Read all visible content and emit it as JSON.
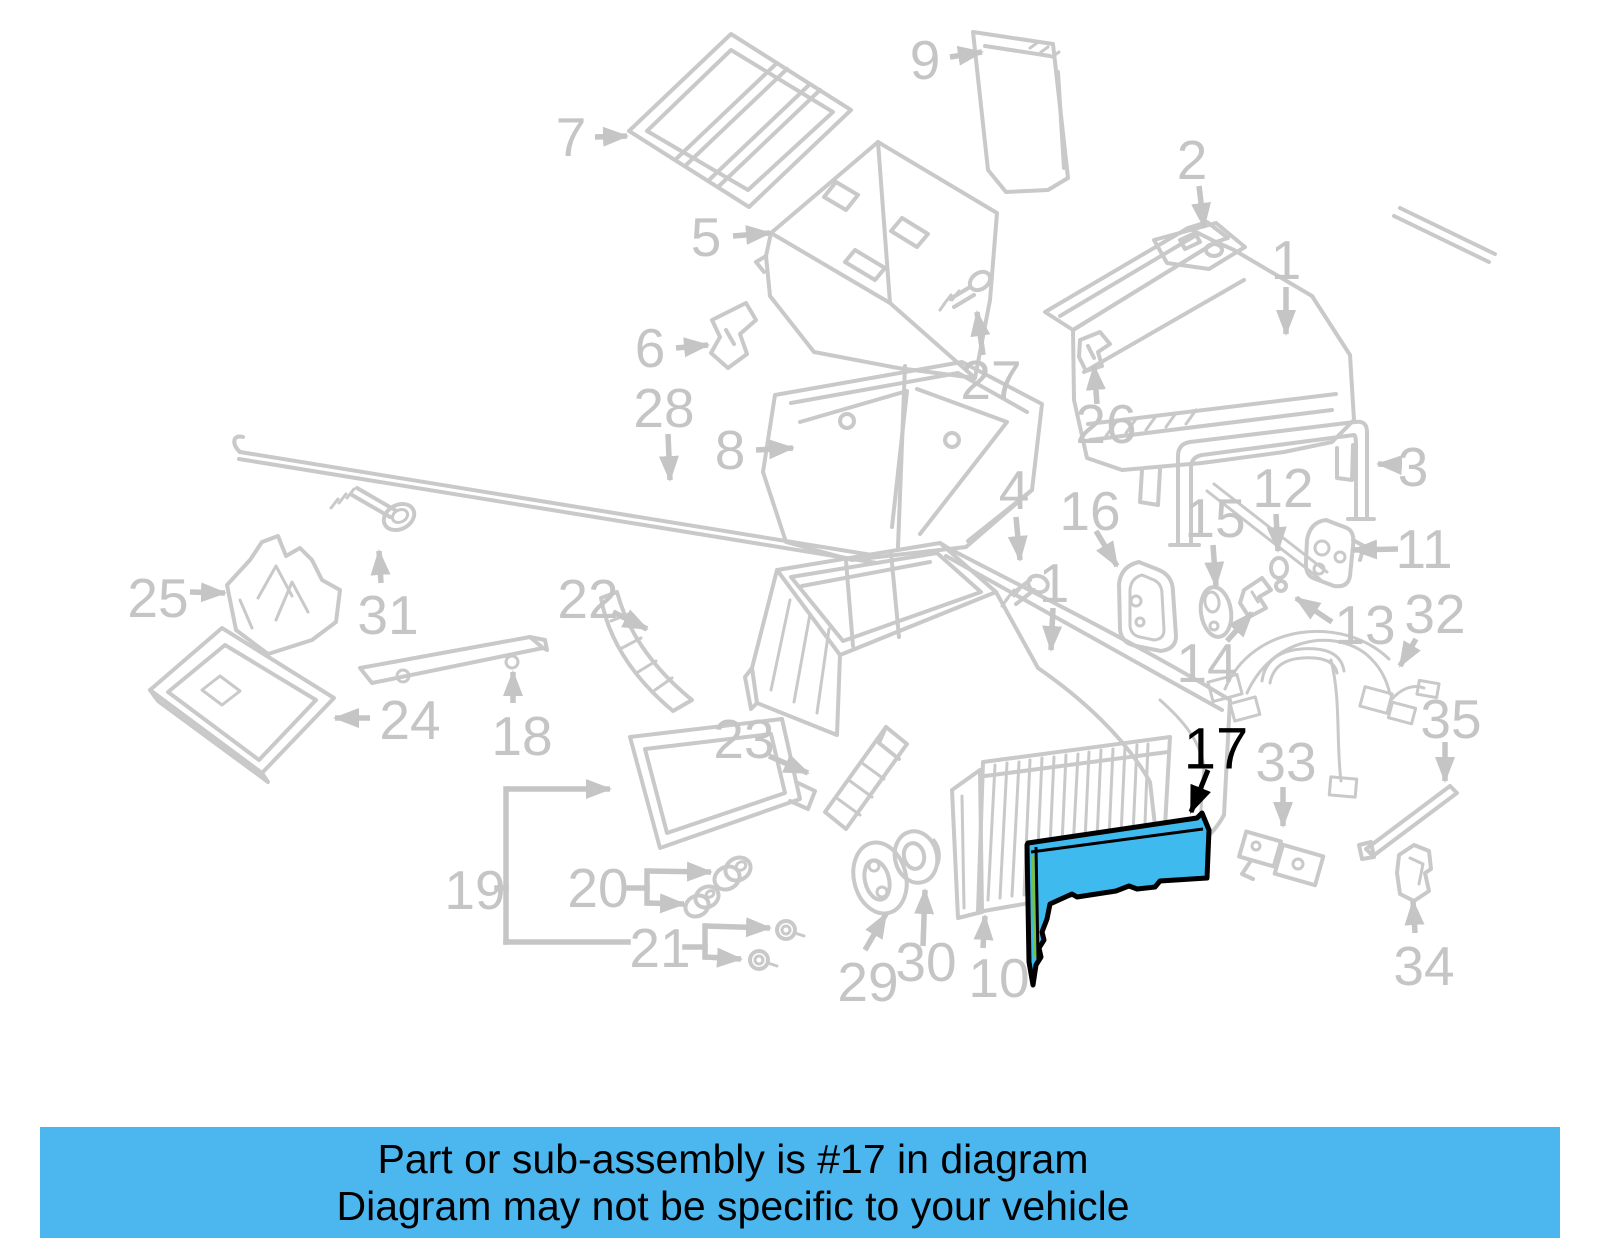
{
  "banner": {
    "line1": "Part or sub-assembly is #17 in diagram",
    "line2": "Diagram may not be specific to your vehicle",
    "background_color": "#4cb6ef",
    "text_color": "#000000"
  },
  "diagram": {
    "background_color": "#ffffff",
    "line_color": "#c9c9c9",
    "label_color": "#c5c5c5",
    "highlight_color": "#000000",
    "highlighted_part": {
      "number": "17",
      "fill_color": "#3fbaee",
      "outline_color": "#000000",
      "accent_color": "#76c043"
    },
    "labels": [
      {
        "n": "7",
        "x": 571,
        "y": 137
      },
      {
        "n": "5",
        "x": 706,
        "y": 237
      },
      {
        "n": "6",
        "x": 650,
        "y": 348
      },
      {
        "n": "9",
        "x": 925,
        "y": 60
      },
      {
        "n": "2",
        "x": 1192,
        "y": 160
      },
      {
        "n": "1",
        "x": 1286,
        "y": 260
      },
      {
        "n": "27",
        "x": 991,
        "y": 380
      },
      {
        "n": "28",
        "x": 664,
        "y": 408
      },
      {
        "n": "8",
        "x": 730,
        "y": 450
      },
      {
        "n": "26",
        "x": 1106,
        "y": 424
      },
      {
        "n": "3",
        "x": 1413,
        "y": 467
      },
      {
        "n": "4",
        "x": 1014,
        "y": 490
      },
      {
        "n": "16",
        "x": 1090,
        "y": 511
      },
      {
        "n": "15",
        "x": 1215,
        "y": 518
      },
      {
        "n": "12",
        "x": 1283,
        "y": 488
      },
      {
        "n": "11",
        "x": 1424,
        "y": 549
      },
      {
        "n": "1",
        "x": 1054,
        "y": 583
      },
      {
        "n": "13",
        "x": 1365,
        "y": 625
      },
      {
        "n": "32",
        "x": 1435,
        "y": 614
      },
      {
        "n": "14",
        "x": 1207,
        "y": 663
      },
      {
        "n": "25",
        "x": 158,
        "y": 598
      },
      {
        "n": "31",
        "x": 388,
        "y": 615
      },
      {
        "n": "22",
        "x": 588,
        "y": 599
      },
      {
        "n": "24",
        "x": 410,
        "y": 720
      },
      {
        "n": "18",
        "x": 522,
        "y": 736
      },
      {
        "n": "23",
        "x": 744,
        "y": 739
      },
      {
        "n": "17",
        "x": 1216,
        "y": 749,
        "hl": true
      },
      {
        "n": "33",
        "x": 1286,
        "y": 762
      },
      {
        "n": "35",
        "x": 1451,
        "y": 719
      },
      {
        "n": "19",
        "x": 475,
        "y": 890
      },
      {
        "n": "20",
        "x": 598,
        "y": 888
      },
      {
        "n": "21",
        "x": 660,
        "y": 948
      },
      {
        "n": "29",
        "x": 868,
        "y": 982
      },
      {
        "n": "30",
        "x": 926,
        "y": 962
      },
      {
        "n": "10",
        "x": 999,
        "y": 978
      },
      {
        "n": "34",
        "x": 1424,
        "y": 966
      }
    ],
    "arrows": [
      {
        "x1": 595,
        "y1": 137,
        "x2": 627,
        "y2": 136
      },
      {
        "x1": 733,
        "y1": 236,
        "x2": 770,
        "y2": 233
      },
      {
        "x1": 676,
        "y1": 348,
        "x2": 708,
        "y2": 345
      },
      {
        "x1": 950,
        "y1": 57,
        "x2": 982,
        "y2": 52
      },
      {
        "x1": 1199,
        "y1": 186,
        "x2": 1204,
        "y2": 227
      },
      {
        "x1": 1286,
        "y1": 287,
        "x2": 1286,
        "y2": 334
      },
      {
        "x1": 983,
        "y1": 355,
        "x2": 977,
        "y2": 312
      },
      {
        "x1": 668,
        "y1": 434,
        "x2": 670,
        "y2": 480
      },
      {
        "x1": 756,
        "y1": 450,
        "x2": 793,
        "y2": 448
      },
      {
        "x1": 1097,
        "y1": 404,
        "x2": 1094,
        "y2": 366
      },
      {
        "x1": 1400,
        "y1": 465,
        "x2": 1378,
        "y2": 464
      },
      {
        "x1": 1016,
        "y1": 517,
        "x2": 1020,
        "y2": 560
      },
      {
        "x1": 1096,
        "y1": 531,
        "x2": 1117,
        "y2": 566
      },
      {
        "x1": 1276,
        "y1": 514,
        "x2": 1278,
        "y2": 551
      },
      {
        "x1": 1213,
        "y1": 545,
        "x2": 1216,
        "y2": 586
      },
      {
        "x1": 1398,
        "y1": 549,
        "x2": 1353,
        "y2": 550
      },
      {
        "x1": 1053,
        "y1": 608,
        "x2": 1051,
        "y2": 650
      },
      {
        "x1": 1332,
        "y1": 622,
        "x2": 1296,
        "y2": 598
      },
      {
        "x1": 1416,
        "y1": 639,
        "x2": 1400,
        "y2": 666
      },
      {
        "x1": 1227,
        "y1": 641,
        "x2": 1252,
        "y2": 613
      },
      {
        "x1": 190,
        "y1": 592,
        "x2": 225,
        "y2": 593
      },
      {
        "x1": 381,
        "y1": 583,
        "x2": 379,
        "y2": 551
      },
      {
        "x1": 613,
        "y1": 612,
        "x2": 647,
        "y2": 629
      },
      {
        "x1": 370,
        "y1": 718,
        "x2": 335,
        "y2": 718
      },
      {
        "x1": 513,
        "y1": 703,
        "x2": 513,
        "y2": 672
      },
      {
        "x1": 769,
        "y1": 756,
        "x2": 808,
        "y2": 773
      },
      {
        "x1": 1208,
        "y1": 770,
        "x2": 1191,
        "y2": 812,
        "hl": true
      },
      {
        "x1": 1283,
        "y1": 787,
        "x2": 1283,
        "y2": 826
      },
      {
        "x1": 1445,
        "y1": 742,
        "x2": 1445,
        "y2": 781
      },
      {
        "x1": 865,
        "y1": 950,
        "x2": 886,
        "y2": 914
      },
      {
        "x1": 923,
        "y1": 946,
        "x2": 925,
        "y2": 890
      },
      {
        "x1": 983,
        "y1": 948,
        "x2": 985,
        "y2": 916
      },
      {
        "x1": 1415,
        "y1": 933,
        "x2": 1413,
        "y2": 901
      },
      {
        "x1": 506,
        "y1": 789,
        "x2": 610,
        "y2": 789
      },
      {
        "x1": 647,
        "y1": 871,
        "x2": 711,
        "y2": 872
      },
      {
        "x1": 647,
        "y1": 903,
        "x2": 684,
        "y2": 904
      },
      {
        "x1": 705,
        "y1": 926,
        "x2": 770,
        "y2": 928
      },
      {
        "x1": 705,
        "y1": 957,
        "x2": 741,
        "y2": 959
      }
    ],
    "brackets": [
      {
        "pts": "497,888 506,888"
      },
      {
        "pts": "506,789 506,942"
      },
      {
        "pts": "506,942 628,942"
      },
      {
        "pts": "626,888 647,888"
      },
      {
        "pts": "647,871 647,903"
      },
      {
        "pts": "685,947 705,947"
      },
      {
        "pts": "705,926 705,957"
      }
    ]
  }
}
